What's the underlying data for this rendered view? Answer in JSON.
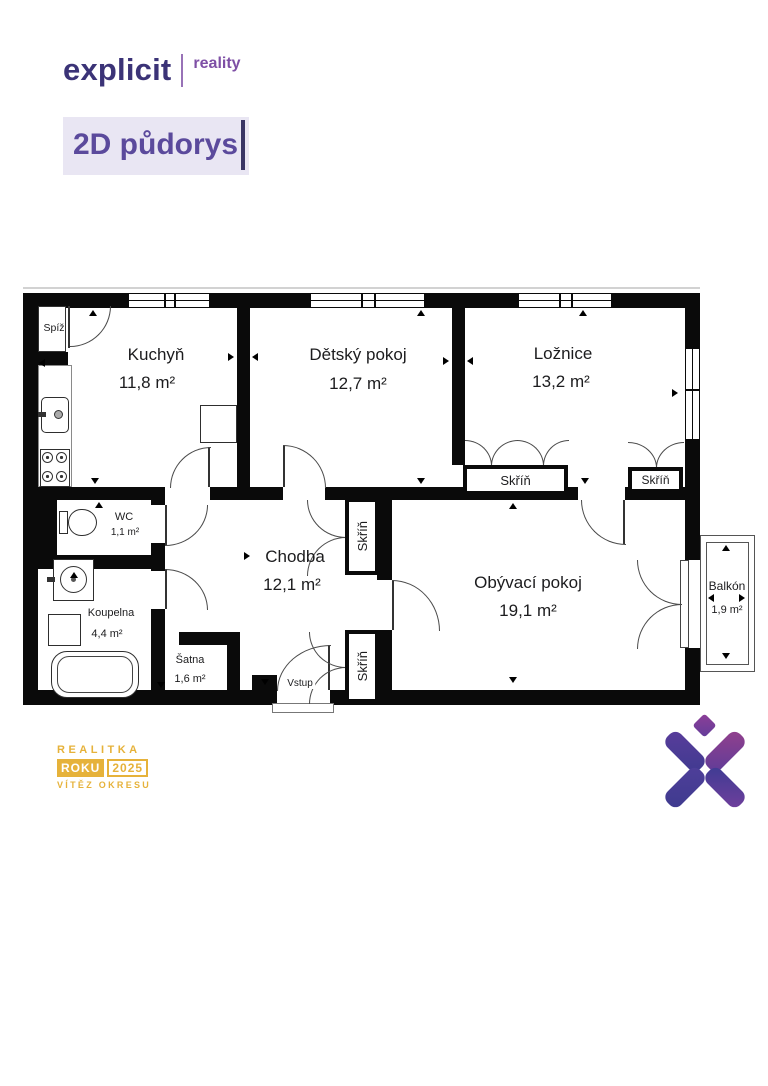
{
  "brand": {
    "name": "explicit",
    "tagline": "reality"
  },
  "page": {
    "title": "2D půdorys"
  },
  "floorplan": {
    "rooms": {
      "spiz": {
        "name": "Spíž"
      },
      "kuchyn": {
        "name": "Kuchyň",
        "area": "11,8 m²"
      },
      "detsky_pokoj": {
        "name": "Dětský pokoj",
        "area": "12,7 m²"
      },
      "loznice": {
        "name": "Ložnice",
        "area": "13,2 m²"
      },
      "wc": {
        "name": "WC",
        "area": "1,1 m²"
      },
      "chodba": {
        "name": "Chodba",
        "area": "12,1 m²"
      },
      "koupelna": {
        "name": "Koupelna",
        "area": "4,4 m²"
      },
      "satna": {
        "name": "Šatna",
        "area": "1,6 m²"
      },
      "obyvaci_pokoj": {
        "name": "Obývací pokoj",
        "area": "19,1 m²"
      },
      "balkon": {
        "name": "Balkón",
        "area": "1,9 m²"
      }
    },
    "labels": {
      "closet": "Skříň",
      "entrance": "Vstup"
    }
  },
  "award_badge": {
    "line1": "REALITKA",
    "word": "ROKU",
    "year": "2025",
    "line3": "VÍTĚZ OKRESU"
  },
  "colors": {
    "brand_dark": "#3b3377",
    "brand_purple": "#7e4fa5",
    "title_bg": "#e9e6f3",
    "title_text": "#5b4a9c",
    "badge_gold": "#e6b23a",
    "wall": "#0a0a0a"
  }
}
